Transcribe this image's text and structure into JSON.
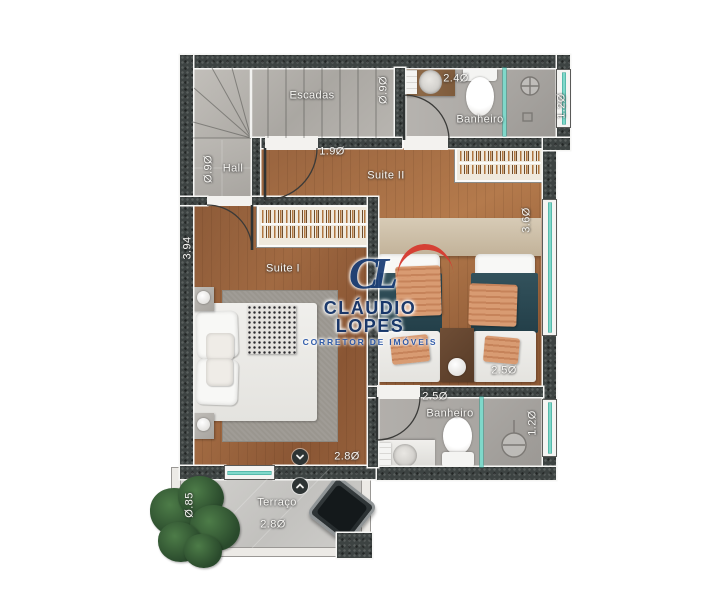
{
  "rooms": {
    "escadas": "Escadas",
    "hall": "Hall",
    "suite1": "Suite I",
    "suite2": "Suite II",
    "banheiro_top": "Banheiro",
    "banheiro_bottom": "Banheiro",
    "terraco": "Terraço"
  },
  "dims": {
    "d_090_stairs": "Ø.9Ø",
    "d_090_hall": "Ø.9Ø",
    "d_240": "2.4Ø",
    "d_120_top": "1.2Ø",
    "d_190": "1.9Ø",
    "d_360": "3.6Ø",
    "d_394": "3.94",
    "d_250_suite": "2.5Ø",
    "d_250_bath": "2.5Ø",
    "d_120_bottom": "1.2Ø",
    "d_280_suite": "2.8Ø",
    "d_280_terrace": "2.8Ø",
    "d_085": "Ø.85"
  },
  "watermark": {
    "monogram": "CL",
    "name": "CLÁUDIO LOPES",
    "tagline": "CORRETOR DE IMÓVEIS",
    "name_color": "#16366b",
    "roof_color": "#d63a2f"
  },
  "colors": {
    "wall": "#3d4342",
    "wood_floor": "#9a6642",
    "tile_floor": "#b6b3af",
    "window_glass": "#7fd8ca",
    "blanket_teal": "#2c4850",
    "pillow_salmon": "#d79c73"
  }
}
